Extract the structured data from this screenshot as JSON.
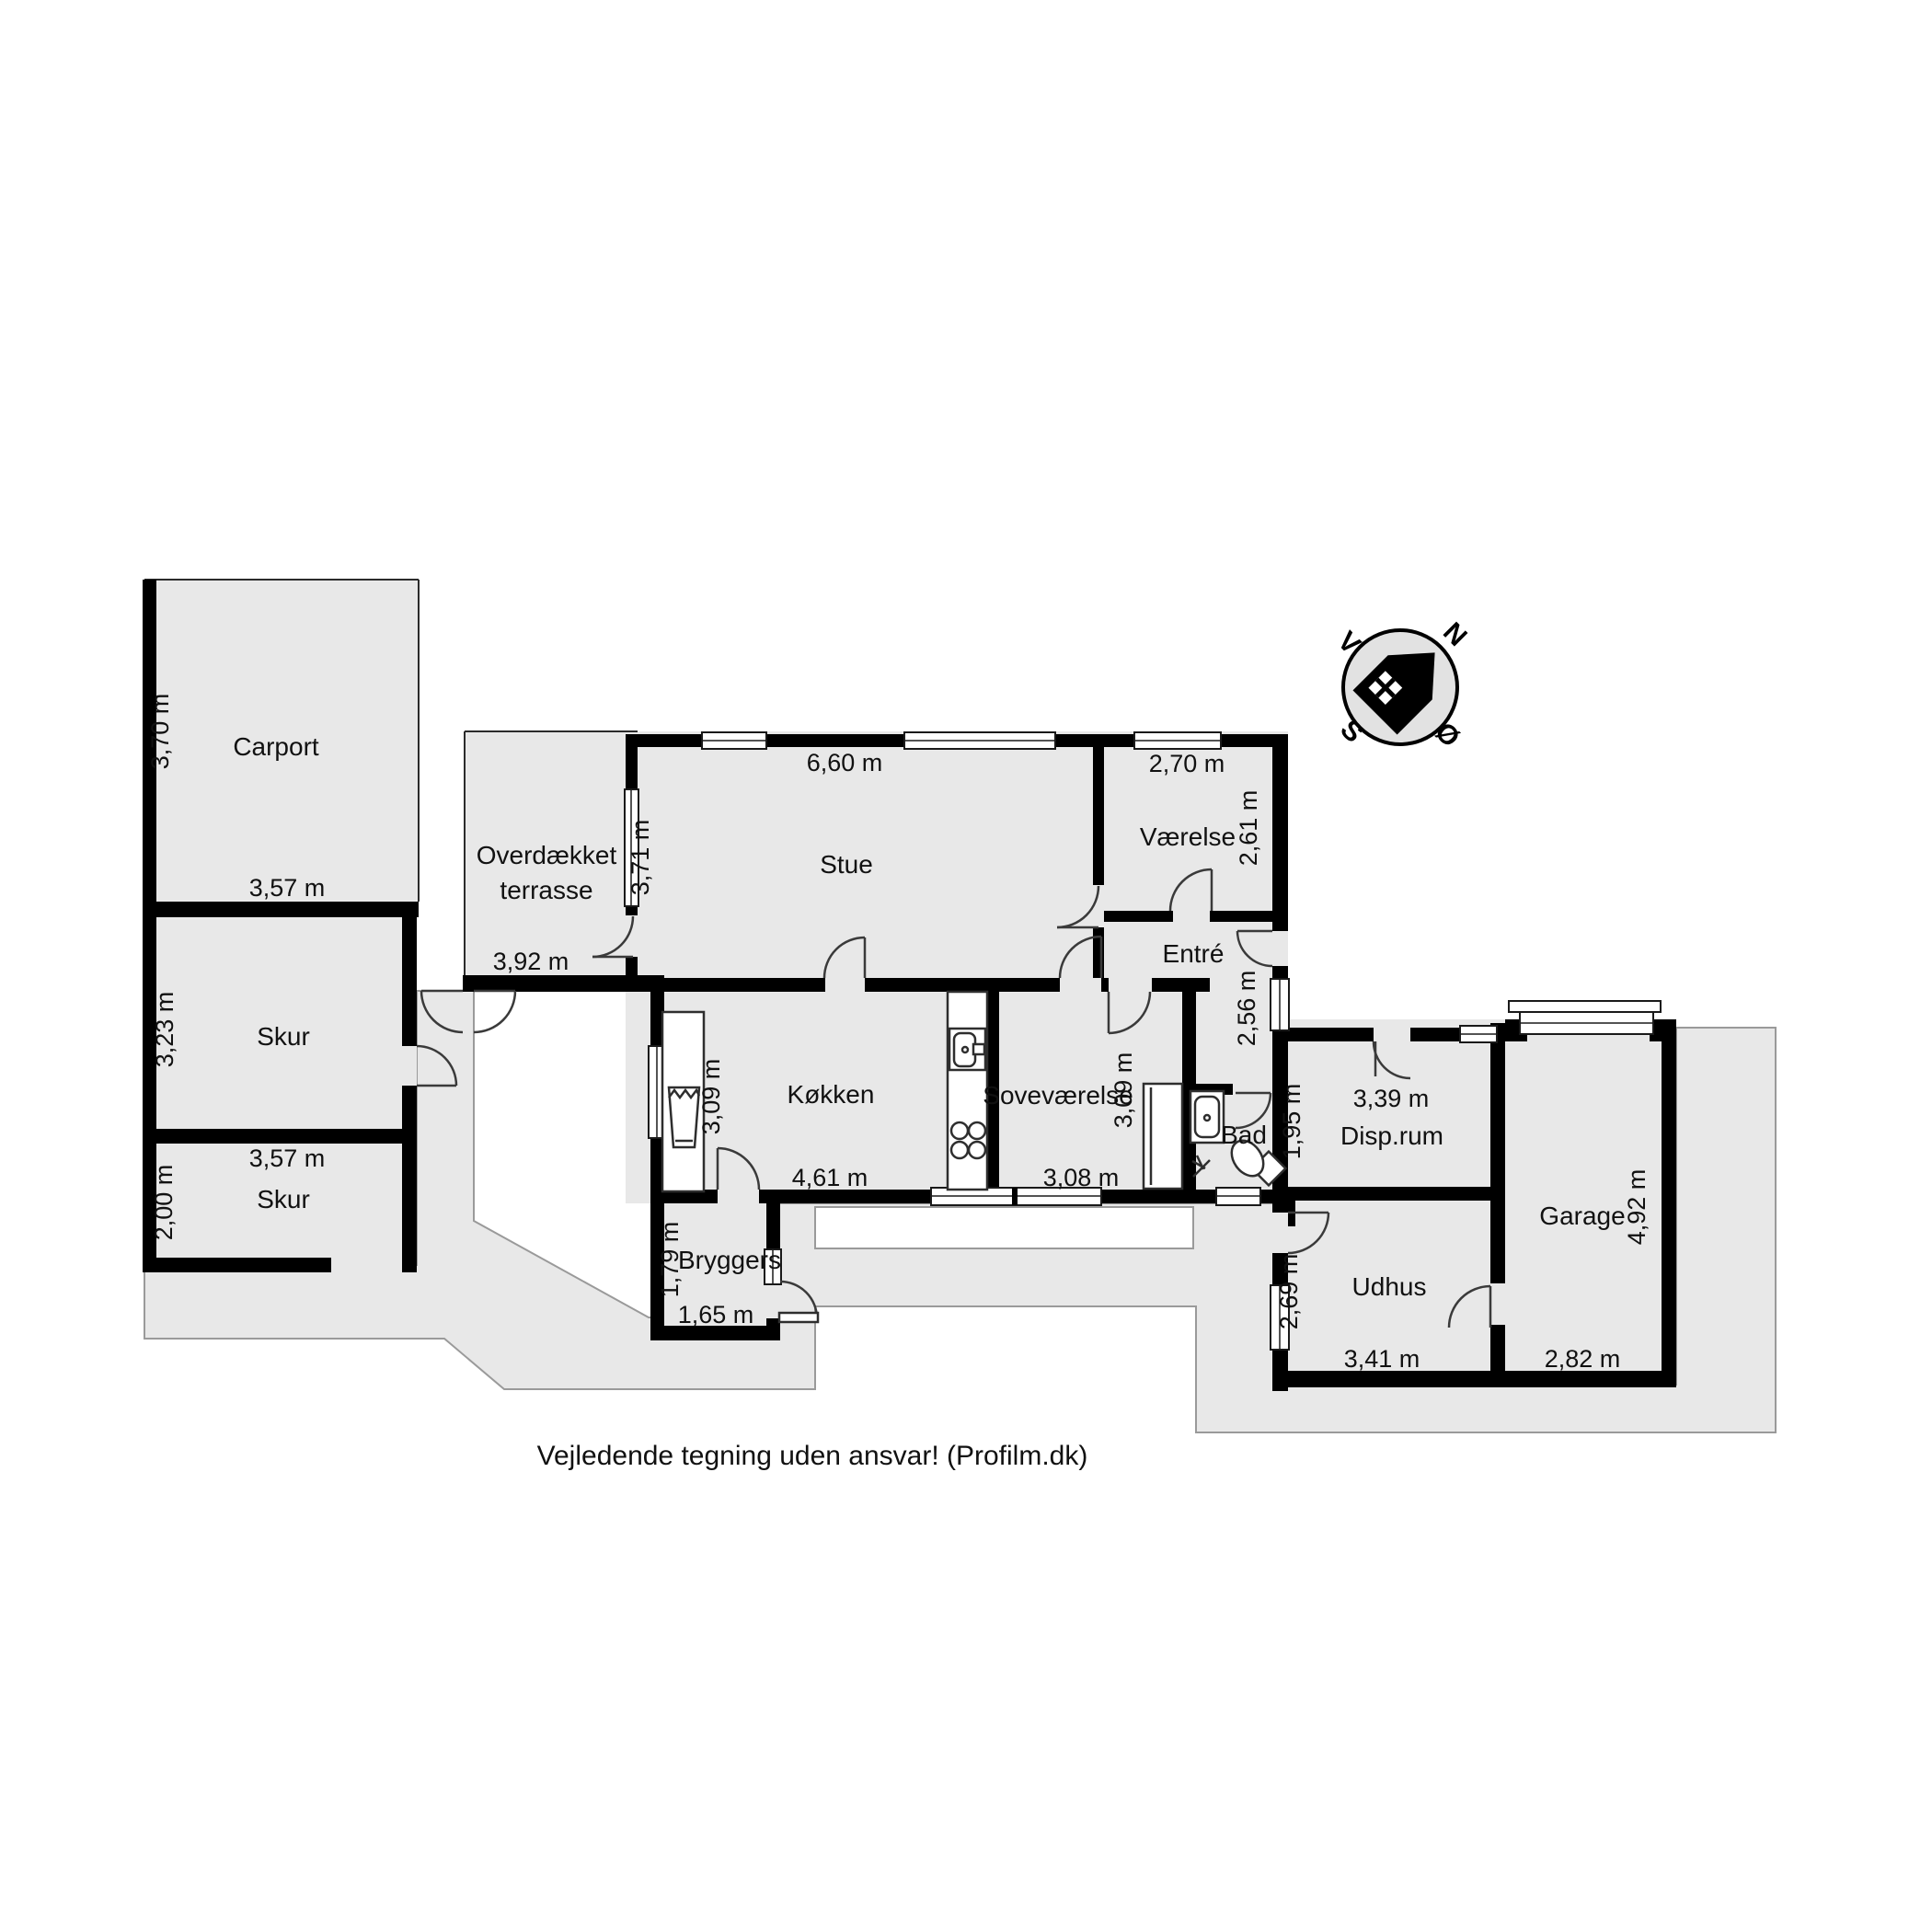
{
  "footer": "Vejledende tegning uden ansvar! (Profilm.dk)",
  "compass": {
    "n": "N",
    "east": "Ø",
    "s": "S",
    "w": "V"
  },
  "colors": {
    "floor": "#e8e8e8",
    "wall": "#000000",
    "outline": "#9a9a9a",
    "background": "#ffffff"
  },
  "rooms": {
    "carport": {
      "label": "Carport",
      "dim_v": "3,70 m",
      "dim_h": "3,57 m"
    },
    "skur1": {
      "label": "Skur",
      "dim_v": "3,23 m",
      "dim_h": "3,57 m"
    },
    "skur2": {
      "label": "Skur",
      "dim_v": "2,00 m"
    },
    "terrasse": {
      "label_line1": "Overdækket",
      "label_line2": "terrasse",
      "dim_h": "3,92 m"
    },
    "stue": {
      "label": "Stue",
      "dim_h": "6,60 m",
      "dim_v": "3,71 m"
    },
    "vaerelse": {
      "label": "Værelse",
      "dim_h": "2,70 m",
      "dim_v": "2,61 m"
    },
    "entre": {
      "label": "Entré",
      "dim_v": "2,56 m"
    },
    "koekken": {
      "label": "Køkken",
      "dim_v": "3,09 m",
      "dim_h": "4,61 m"
    },
    "sovevaerelse": {
      "label": "Soveværelse",
      "dim_v": "3,09 m",
      "dim_h": "3,08 m"
    },
    "bad": {
      "label": "Bad"
    },
    "disprum": {
      "label": "Disp.rum",
      "dim_h": "3,39 m",
      "dim_v": "1,95 m"
    },
    "bryggers": {
      "label": "Bryggers",
      "dim_v": "1,79 m",
      "dim_h": "1,65 m"
    },
    "udhus": {
      "label": "Udhus",
      "dim_v": "2,69 m",
      "dim_h": "3,41 m"
    },
    "garage": {
      "label": "Garage",
      "dim_v": "4,92 m",
      "dim_h": "2,82 m"
    }
  }
}
